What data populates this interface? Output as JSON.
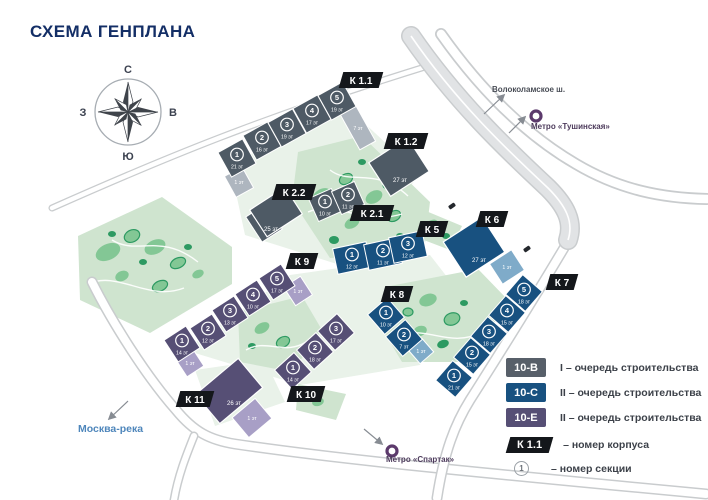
{
  "title": "СХЕМА ГЕНПЛАНА",
  "compass": {
    "north": "С",
    "south": "Ю",
    "west": "З",
    "east": "В"
  },
  "colors": {
    "title": "#132e66",
    "river": "#4e86bb",
    "metro": "#5c3a6c",
    "tag": "#14171b",
    "road": "#e1e3e5",
    "park": "#cfe4cf"
  },
  "phases": {
    "gray": {
      "fill": "#4e5a65",
      "annex": "#aeb6bf"
    },
    "blue": {
      "fill": "#185180",
      "annex": "#7fabc9"
    },
    "purple": {
      "fill": "#564f75",
      "annex": "#a89fc6"
    }
  },
  "buildings": [
    {
      "id": "k1_1",
      "tag": "К 1.1",
      "phase": "gray",
      "sections": [
        {
          "num": "1",
          "floors": "21 эт"
        },
        {
          "num": "2",
          "floors": "16 эт"
        },
        {
          "num": "3",
          "floors": "19 эт"
        },
        {
          "num": "4",
          "floors": "17 эт"
        },
        {
          "num": "5",
          "floors": "19 эт"
        }
      ],
      "annex_labels": [
        "1 эт",
        "7 эт"
      ]
    },
    {
      "id": "k1_2",
      "tag": "К 1.2",
      "phase": "gray",
      "floors": "27 эт",
      "sections": [],
      "annex_labels": []
    },
    {
      "id": "k2_2",
      "tag": "К 2.2",
      "phase": "gray",
      "floors": "25 эт",
      "sections": [],
      "annex_labels": []
    },
    {
      "id": "k2_1",
      "tag": "К 2.1",
      "phase": "gray",
      "sections": [
        {
          "num": "1",
          "floors": "10 эт"
        },
        {
          "num": "2",
          "floors": "11 эт"
        }
      ],
      "annex_labels": []
    },
    {
      "id": "k5",
      "tag": "К 5",
      "phase": "blue",
      "sections": [
        {
          "num": "1",
          "floors": "12 эт"
        },
        {
          "num": "2",
          "floors": "11 эт"
        },
        {
          "num": "3",
          "floors": "12 эт"
        }
      ],
      "annex_labels": []
    },
    {
      "id": "k6",
      "tag": "К 6",
      "phase": "blue",
      "floors": "27 эт",
      "sections": [],
      "annex_labels": [
        "1 эт"
      ]
    },
    {
      "id": "k7",
      "tag": "К 7",
      "phase": "blue",
      "sections": [
        {
          "num": "1",
          "floors": "21 эт"
        },
        {
          "num": "2",
          "floors": "15 эт"
        },
        {
          "num": "3",
          "floors": "18 эт"
        },
        {
          "num": "4",
          "floors": "15 эт"
        },
        {
          "num": "5",
          "floors": "18 эт"
        }
      ],
      "annex_labels": []
    },
    {
      "id": "k8",
      "tag": "К 8",
      "phase": "blue",
      "sections": [
        {
          "num": "1",
          "floors": "10 эт"
        },
        {
          "num": "2",
          "floors": "7 эт"
        }
      ],
      "annex_labels": [
        "1 эт"
      ]
    },
    {
      "id": "k9",
      "tag": "К 9",
      "phase": "purple",
      "sections": [
        {
          "num": "1",
          "floors": "14 эт"
        },
        {
          "num": "2",
          "floors": "12 эт"
        },
        {
          "num": "3",
          "floors": "13 эт"
        },
        {
          "num": "4",
          "floors": "10 эт"
        },
        {
          "num": "5",
          "floors": "17 эт"
        }
      ],
      "annex_labels": [
        "1 эт",
        "1 эт"
      ]
    },
    {
      "id": "k10",
      "tag": "К 10",
      "phase": "purple",
      "sections": [
        {
          "num": "1",
          "floors": "14 эт"
        },
        {
          "num": "2",
          "floors": "18 эт"
        },
        {
          "num": "3",
          "floors": "17 эт"
        }
      ],
      "annex_labels": []
    },
    {
      "id": "k11",
      "tag": "К 11",
      "phase": "purple",
      "floors": "26 эт",
      "sections": [],
      "annex_labels": [
        "1 эт"
      ]
    }
  ],
  "legend": {
    "items": [
      {
        "swatch": "10-В",
        "color": "#575f69",
        "text": "I – очередь строительства"
      },
      {
        "swatch": "10-С",
        "color": "#185180",
        "text": "II – очередь строительства"
      },
      {
        "swatch": "10-Е",
        "color": "#564f75",
        "text": "II – очередь строительства"
      }
    ],
    "corpus": {
      "tag": "К 1.1",
      "text": "– номер корпуса"
    },
    "section": {
      "num": "1",
      "text": "– номер секции"
    }
  },
  "annotations": {
    "highway": "Волоколамское ш.",
    "metro_tushinskaya": "Метро «Тушинская»",
    "metro_spartak": "Метро «Спартак»",
    "river": "Москва-река"
  }
}
